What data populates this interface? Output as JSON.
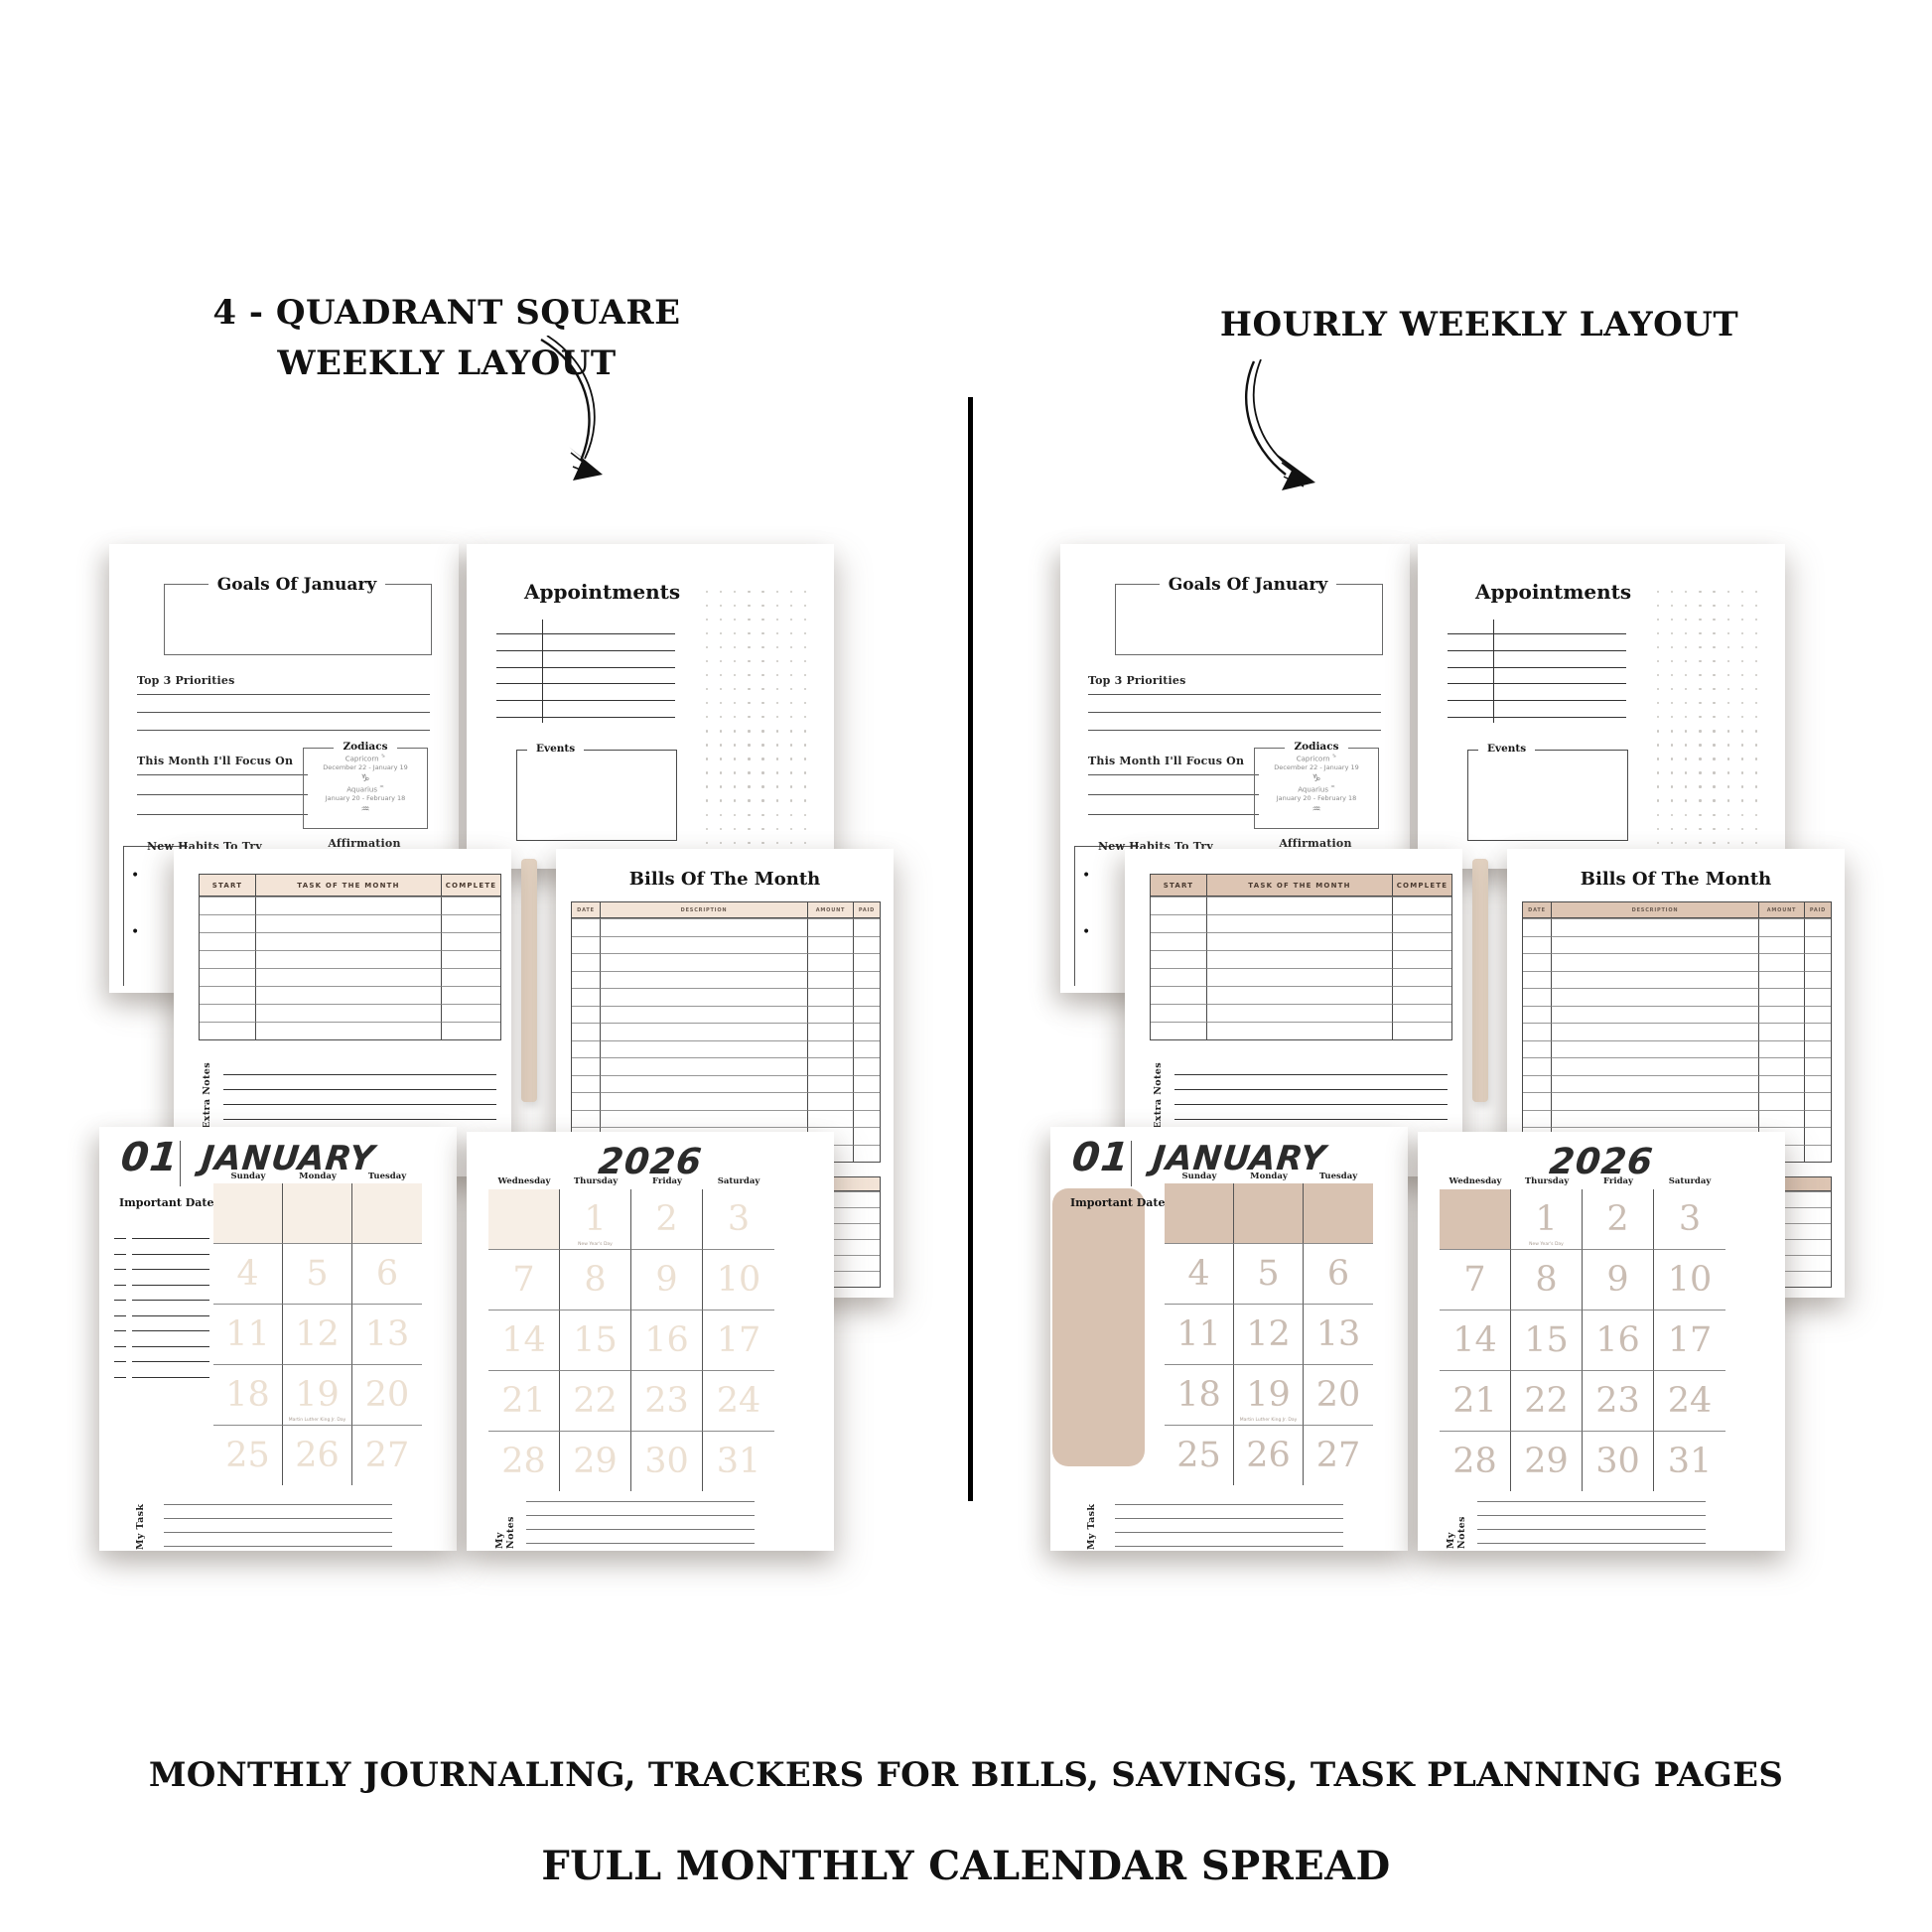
{
  "headlines": {
    "left": "4 - QUADRANT SQUARE WEEKLY LAYOUT",
    "right": "HOURLY WEEKLY LAYOUT",
    "bottom_line1": "MONTHLY JOURNALING, TRACKERS FOR BILLS, SAVINGS, TASK PLANNING PAGES",
    "bottom_line2": "FULL MONTHLY CALENDAR SPREAD"
  },
  "colors": {
    "cream_cell": "#f7efe6",
    "tan_cell": "#d8c2b1",
    "table_header_beige": "#f3e4d7",
    "faint_number_cream": "#ece0d2",
    "faint_number_tan": "#cabdb3",
    "ink": "#111111"
  },
  "goals_page": {
    "title": "Goals Of January",
    "priorities_label": "Top 3 Priorities",
    "focus_label": "This Month I'll Focus On",
    "habits_label": "New Habits To Try",
    "affirmation_label": "Affirmation",
    "zodiacs": {
      "title": "Zodiacs",
      "signs": [
        {
          "name": "Capricorn",
          "symbol": "♑",
          "dates": "December 22 - January 19",
          "glyph": "♑",
          "icon": "capricorn-goat-icon"
        },
        {
          "name": "Aquarius",
          "symbol": "♒",
          "dates": "January 20 - February  18",
          "glyph": "♒",
          "icon": "aquarius-water-bearer-icon"
        }
      ]
    }
  },
  "appointments_page": {
    "title": "Appointments",
    "events_label": "Events"
  },
  "task_page": {
    "columns": [
      "START",
      "TASK OF THE MONTH",
      "COMPLETE"
    ],
    "empty_row_count": 8,
    "extra_notes_label": "Extra Notes"
  },
  "bills_page": {
    "title": "Bills Of The Month",
    "columns": [
      "DATE",
      "DESCRIPTION",
      "AMOUNT",
      "PAID"
    ],
    "empty_row_count": 14,
    "second_tracker_row_count": 6
  },
  "calendar": {
    "month_number": "01",
    "month_name": "JANUARY",
    "year": "2026",
    "important_dates_label": "Important Dates",
    "my_task_label": "My Task",
    "my_notes_label": "My Notes",
    "month_days": [
      "Sunday",
      "Monday",
      "Tuesday"
    ],
    "year_days": [
      "Wednesday",
      "Thursday",
      "Friday",
      "Saturday"
    ],
    "month_rows": [
      [
        "",
        "",
        ""
      ],
      [
        "4",
        "5",
        "6"
      ],
      [
        "11",
        "12",
        "13"
      ],
      [
        "18",
        "19",
        "20"
      ],
      [
        "25",
        "26",
        "27"
      ]
    ],
    "year_rows": [
      [
        "",
        "1",
        "2",
        "3"
      ],
      [
        "7",
        "8",
        "9",
        "10"
      ],
      [
        "14",
        "15",
        "16",
        "17"
      ],
      [
        "21",
        "22",
        "23",
        "24"
      ],
      [
        "28",
        "29",
        "30",
        "31"
      ]
    ],
    "holidays": {
      "1": "New Year's Day",
      "19": "Martin Luther King Jr. Day"
    }
  }
}
